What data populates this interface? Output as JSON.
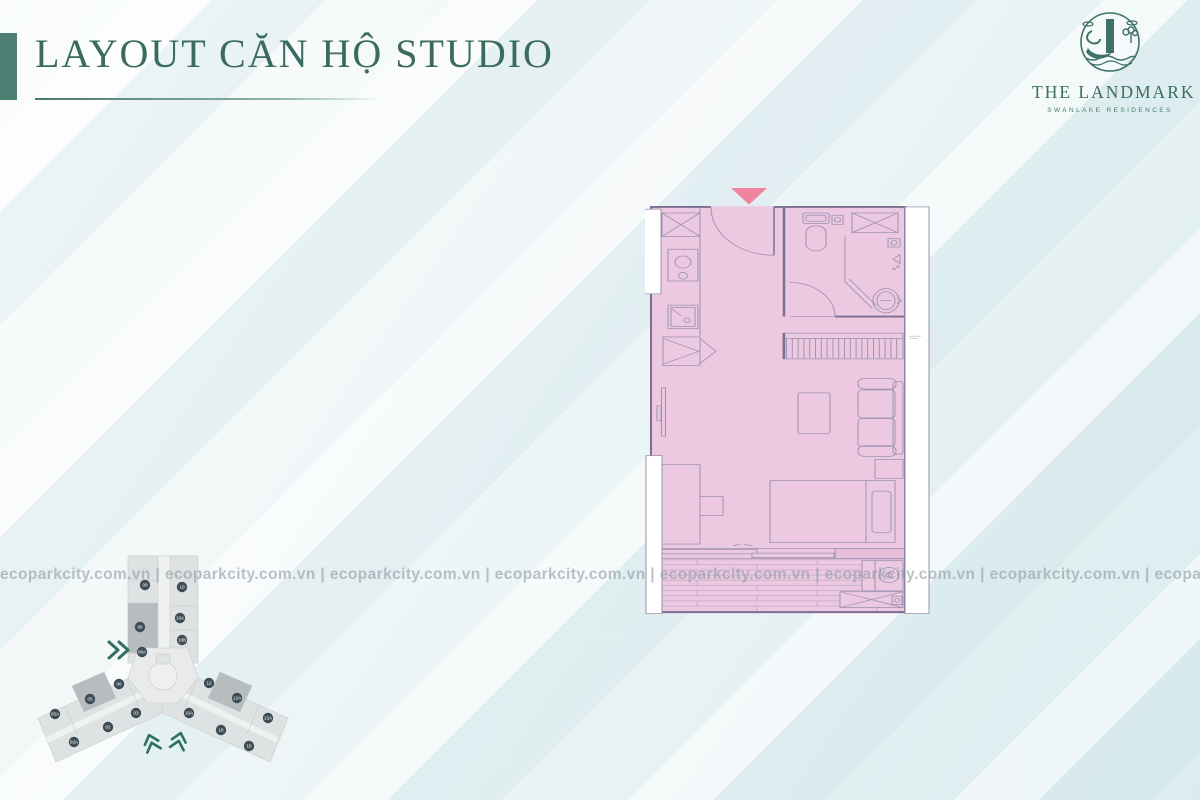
{
  "slide": {
    "title": "LAYOUT CĂN HỘ STUDIO"
  },
  "logo": {
    "name": "THE LANDMARK",
    "tagline": "SWANLAKE RESIDENCES"
  },
  "watermark": {
    "line": "ecoparkcity.com.vn | ecoparkcity.com.vn | ecoparkcity.com.vn | ecoparkcity.com.vn | ecoparkcity.com.vn | ecoparkcity.com.vn | ecoparkcity.com.vn | ecoparkcity.com.vn | ecoparkcity.com.vn | ecoparkcity.com.vn"
  },
  "key_plan": {
    "unit_labels": [
      "09",
      "10",
      "08",
      "10A",
      "10B",
      "08A",
      "06",
      "05",
      "05A",
      "03",
      "02",
      "02A",
      "12",
      "12A",
      "15A",
      "16A",
      "16",
      "15"
    ]
  },
  "floor_plan": {
    "fill_color": "#ecc9e1",
    "wall_color": "#7a6e91",
    "entrance_marker_color": "#f0849f"
  },
  "colors": {
    "accent_teal": "#3a6b5e",
    "background_tint": "#dbecef",
    "watermark_gray": "#8f9ea6"
  }
}
